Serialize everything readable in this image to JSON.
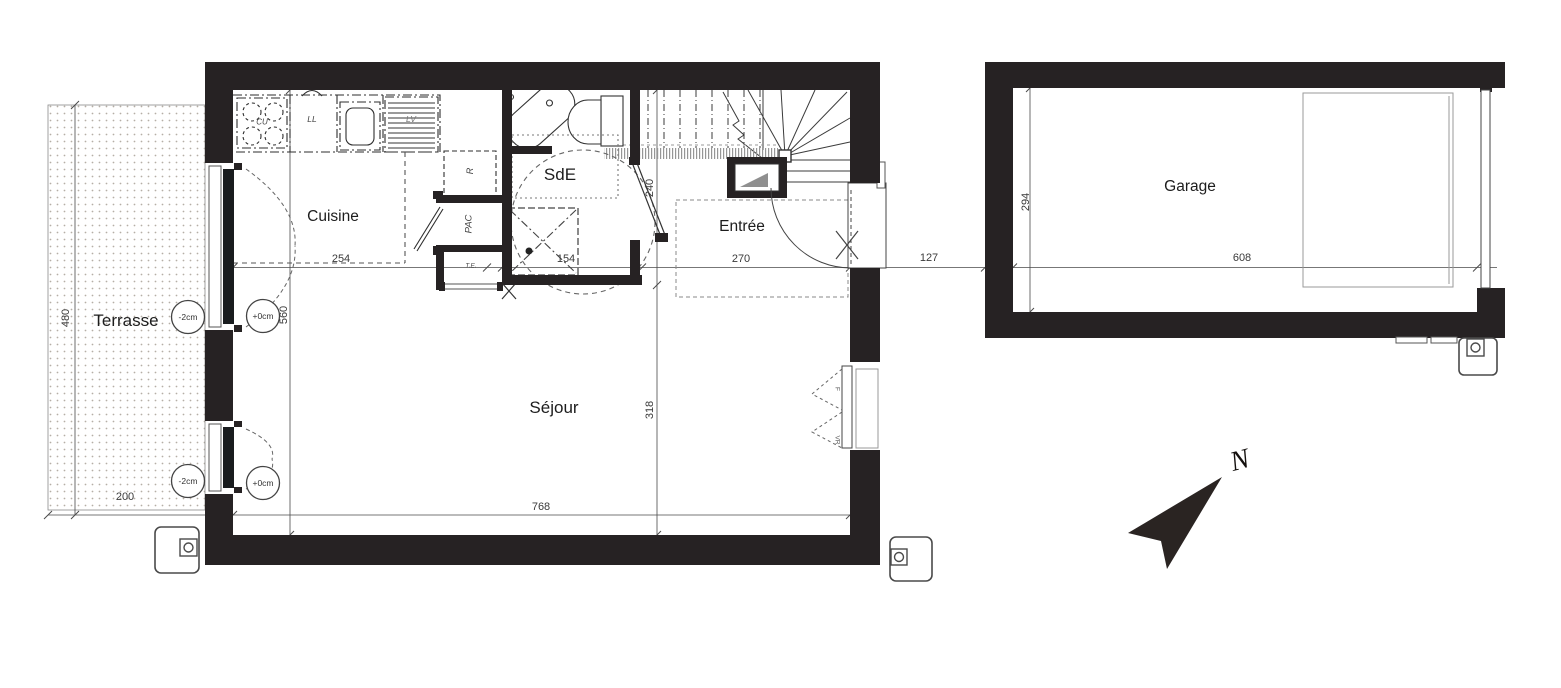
{
  "rooms": {
    "cuisine": "Cuisine",
    "sde": "SdE",
    "entree": "Entrée",
    "sejour": "Séjour",
    "terrasse": "Terrasse",
    "garage": "Garage"
  },
  "dims": {
    "kitchen_width": "254",
    "shower_width": "154",
    "entree_width": "270",
    "house_garage_gap": "127",
    "garage_width": "608",
    "garage_depth": "294",
    "interior_height": "560",
    "sde_height": "240",
    "sejour_height": "318",
    "sejour_width": "768",
    "terrasse_height": "480",
    "terrasse_width": "200"
  },
  "appliances": {
    "cooktop": "CU",
    "washer": "LL",
    "dishwasher": "LV",
    "fridge": "R",
    "heat_pump": "PAC",
    "electrical_panel": "T.E."
  },
  "markers": {
    "terrace_upper": "-2cm",
    "inner_upper": "+0cm",
    "terrace_lower": "-2cm",
    "inner_lower": "+0cm"
  },
  "window_tags": {
    "f": "F",
    "vr": "VR"
  },
  "compass": {
    "north": "N"
  },
  "colors": {
    "wall": "#262223",
    "line": "#3a3a3a"
  }
}
